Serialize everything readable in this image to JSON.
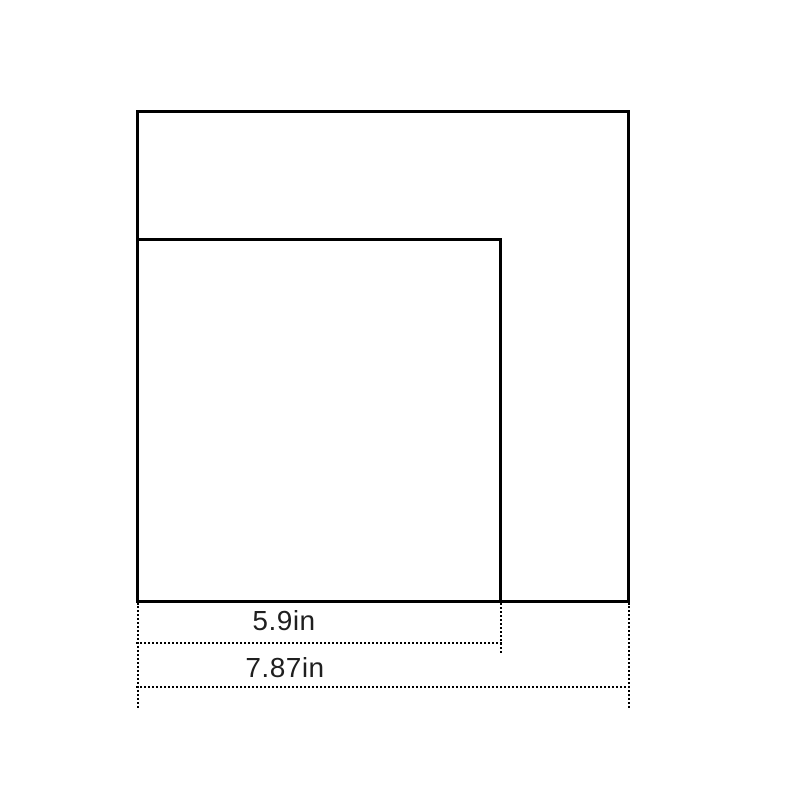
{
  "canvas": {
    "background": "#ffffff",
    "line_color": "#000000",
    "label_color": "#1f1f1f"
  },
  "figure": {
    "type": "nested-squares-dimension-diagram",
    "shapes": [
      {
        "name": "outer-square",
        "side_label": "7.87in"
      },
      {
        "name": "inner-square",
        "side_label": "5.9in"
      }
    ]
  },
  "dimensions": [
    {
      "label": "5.9in",
      "value": 5.9,
      "unit": "in",
      "measures": "inner-square-width"
    },
    {
      "label": "7.87in",
      "value": 7.87,
      "unit": "in",
      "measures": "outer-square-width"
    }
  ]
}
